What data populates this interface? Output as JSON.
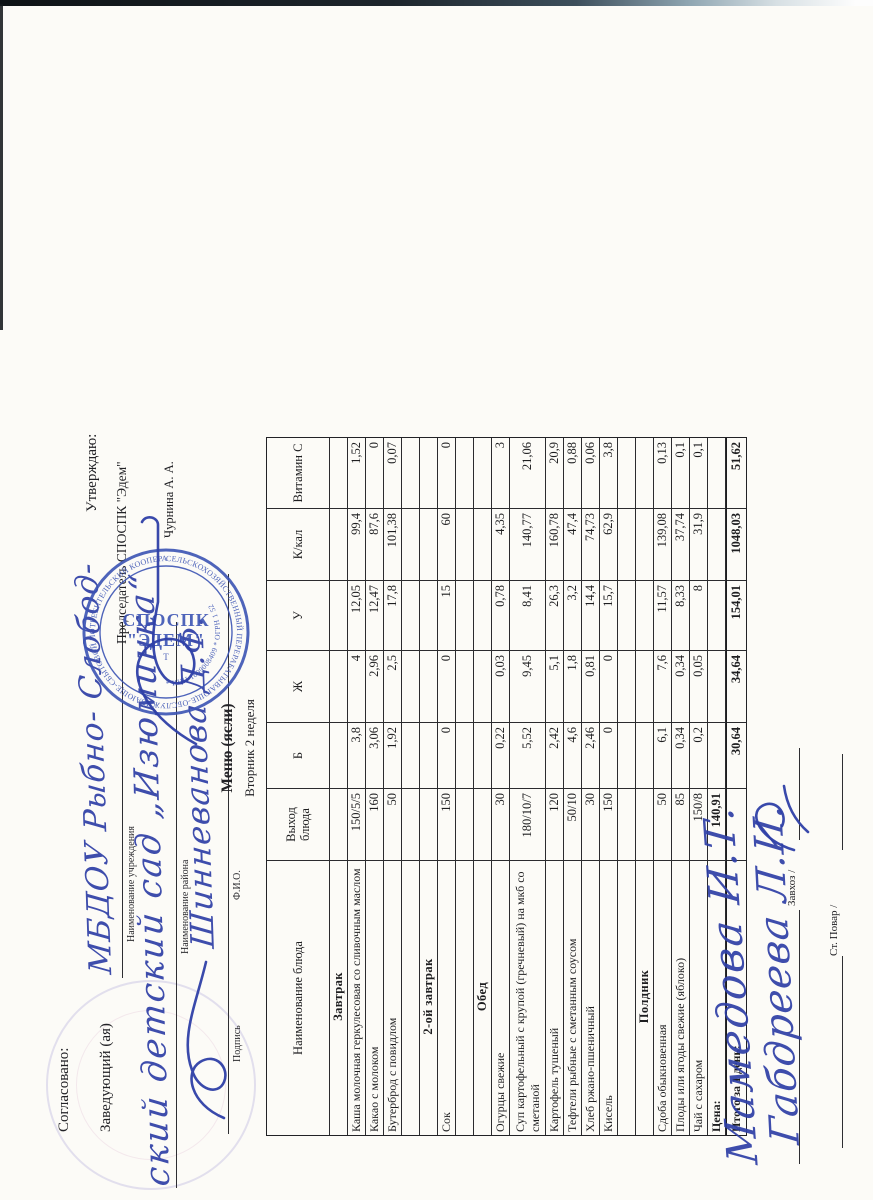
{
  "colors": {
    "handwriting": "#2e3fa6",
    "stamp": "#3c54b4"
  },
  "approval_left": {
    "title": "Согласовано:",
    "role_line": "Заведующий (ая)",
    "handwriting_institution": "МБДОУ Рыбно- Слобод-",
    "institution_label": "Наименование учреждения",
    "handwriting_district": "ский детский сад „Изюминка“",
    "district_label": "Наименование района",
    "signature_label": "Подпись",
    "handwriting_name": "Шинневанова Д.Ф.",
    "name_label": "Ф.И.О."
  },
  "approval_right": {
    "title": "Утверждаю:",
    "role_line": "Председатель СПОСПК \"Эдем\"",
    "approver_name": "Чурнина А. А."
  },
  "stamp": {
    "ring_text": "СЕЛЬСКОХОЗЯЙСТВЕННЫЙ ПЕРЕРАБАТЫВАЮЩЕ-ОБСЛУЖИВАЮЩЕ-СБЫТОВОЙ ПОТРЕБИТЕЛЬСКИЙ КООПЕРАТИВ",
    "ring2_text": "* ИНН 1609008409 * ОГРН 1 52",
    "center_line1": "СПОСПК",
    "center_line2": "\"ЭДЕМ\"",
    "center_line3": "Т"
  },
  "menu": {
    "title": "Меню (ясли)",
    "subtitle": "Вторник 2 неделя"
  },
  "table": {
    "headers": [
      "Наименование блюда",
      "Выход блюда",
      "Б",
      "Ж",
      "У",
      "К/кал",
      "Витамин С"
    ],
    "rows": [
      {
        "type": "section",
        "name": "Завтрак"
      },
      {
        "type": "dish",
        "name": "Каша молочная геркулесовая со сливочным маслом",
        "out": "150/5/5",
        "b": "3,8",
        "zh": "4",
        "u": "12,05",
        "kcal": "99,4",
        "vitc": "1,52"
      },
      {
        "type": "dish",
        "name": "Какао с молоком",
        "out": "160",
        "b": "3,06",
        "zh": "2,96",
        "u": "12,47",
        "kcal": "87,6",
        "vitc": "0"
      },
      {
        "type": "dish",
        "name": "Бутерброд с повидлом",
        "out": "50",
        "b": "1,92",
        "zh": "2,5",
        "u": "17,8",
        "kcal": "101,38",
        "vitc": "0,07"
      },
      {
        "type": "spacer"
      },
      {
        "type": "section",
        "name": "2-ой завтрак"
      },
      {
        "type": "dish",
        "name": "Сок",
        "out": "150",
        "b": "0",
        "zh": "0",
        "u": "15",
        "kcal": "60",
        "vitc": "0"
      },
      {
        "type": "spacer"
      },
      {
        "type": "section",
        "name": "Обед"
      },
      {
        "type": "dish",
        "name": "Огурцы свежие",
        "out": "30",
        "b": "0,22",
        "zh": "0,03",
        "u": "0,78",
        "kcal": "4,35",
        "vitc": "3"
      },
      {
        "type": "dish",
        "tall": true,
        "name": "Суп картофельный с крупой (гречневый) на мкб со сметаной",
        "out": "180/10/7",
        "b": "5,52",
        "zh": "9,45",
        "u": "8,41",
        "kcal": "140,77",
        "vitc": "21,06"
      },
      {
        "type": "dish",
        "name": "Картофель тушеный",
        "out": "120",
        "b": "2,42",
        "zh": "5,1",
        "u": "26,3",
        "kcal": "160,78",
        "vitc": "20,9"
      },
      {
        "type": "dish",
        "name": "Тефтели рыбные с сметанным соусом",
        "out": "50/10",
        "b": "4,6",
        "zh": "1,8",
        "u": "3,2",
        "kcal": "47,4",
        "vitc": "0,88"
      },
      {
        "type": "dish",
        "name": "Хлеб ржано-пшеничный",
        "out": "30",
        "b": "2,46",
        "zh": "0,81",
        "u": "14,4",
        "kcal": "74,73",
        "vitc": "0,06"
      },
      {
        "type": "dish",
        "name": "Кисель",
        "out": "150",
        "b": "0",
        "zh": "0",
        "u": "15,7",
        "kcal": "62,9",
        "vitc": "3,8"
      },
      {
        "type": "spacer"
      },
      {
        "type": "section",
        "name": "Полдник"
      },
      {
        "type": "dish",
        "name": "Сдоба обыкновенная",
        "out": "50",
        "b": "6,1",
        "zh": "7,6",
        "u": "11,57",
        "kcal": "139,08",
        "vitc": "0,13"
      },
      {
        "type": "dish",
        "name": "Плоды или ягоды свежие (яблоко)",
        "out": "85",
        "b": "0,34",
        "zh": "0,34",
        "u": "8,33",
        "kcal": "37,74",
        "vitc": "0,1"
      },
      {
        "type": "dish",
        "name": "Чай с сахаром",
        "out": "150/8",
        "b": "0,2",
        "zh": "0,05",
        "u": "8",
        "kcal": "31,9",
        "vitc": "0,1"
      },
      {
        "type": "price",
        "name": "Цена:",
        "out": "140,91"
      },
      {
        "type": "grand",
        "name": "Итого за 1 день:",
        "b": "30,64",
        "zh": "34,64",
        "u": "154,01",
        "kcal": "1048,03",
        "vitc": "51,62"
      }
    ]
  },
  "footer": {
    "zavhoz_signature": "Мамедова И.Т.",
    "zavhoz_label": "Завхоз /",
    "cook_signature": "Габдреева Л.И.",
    "cook_label": "Ст. Повар /"
  }
}
